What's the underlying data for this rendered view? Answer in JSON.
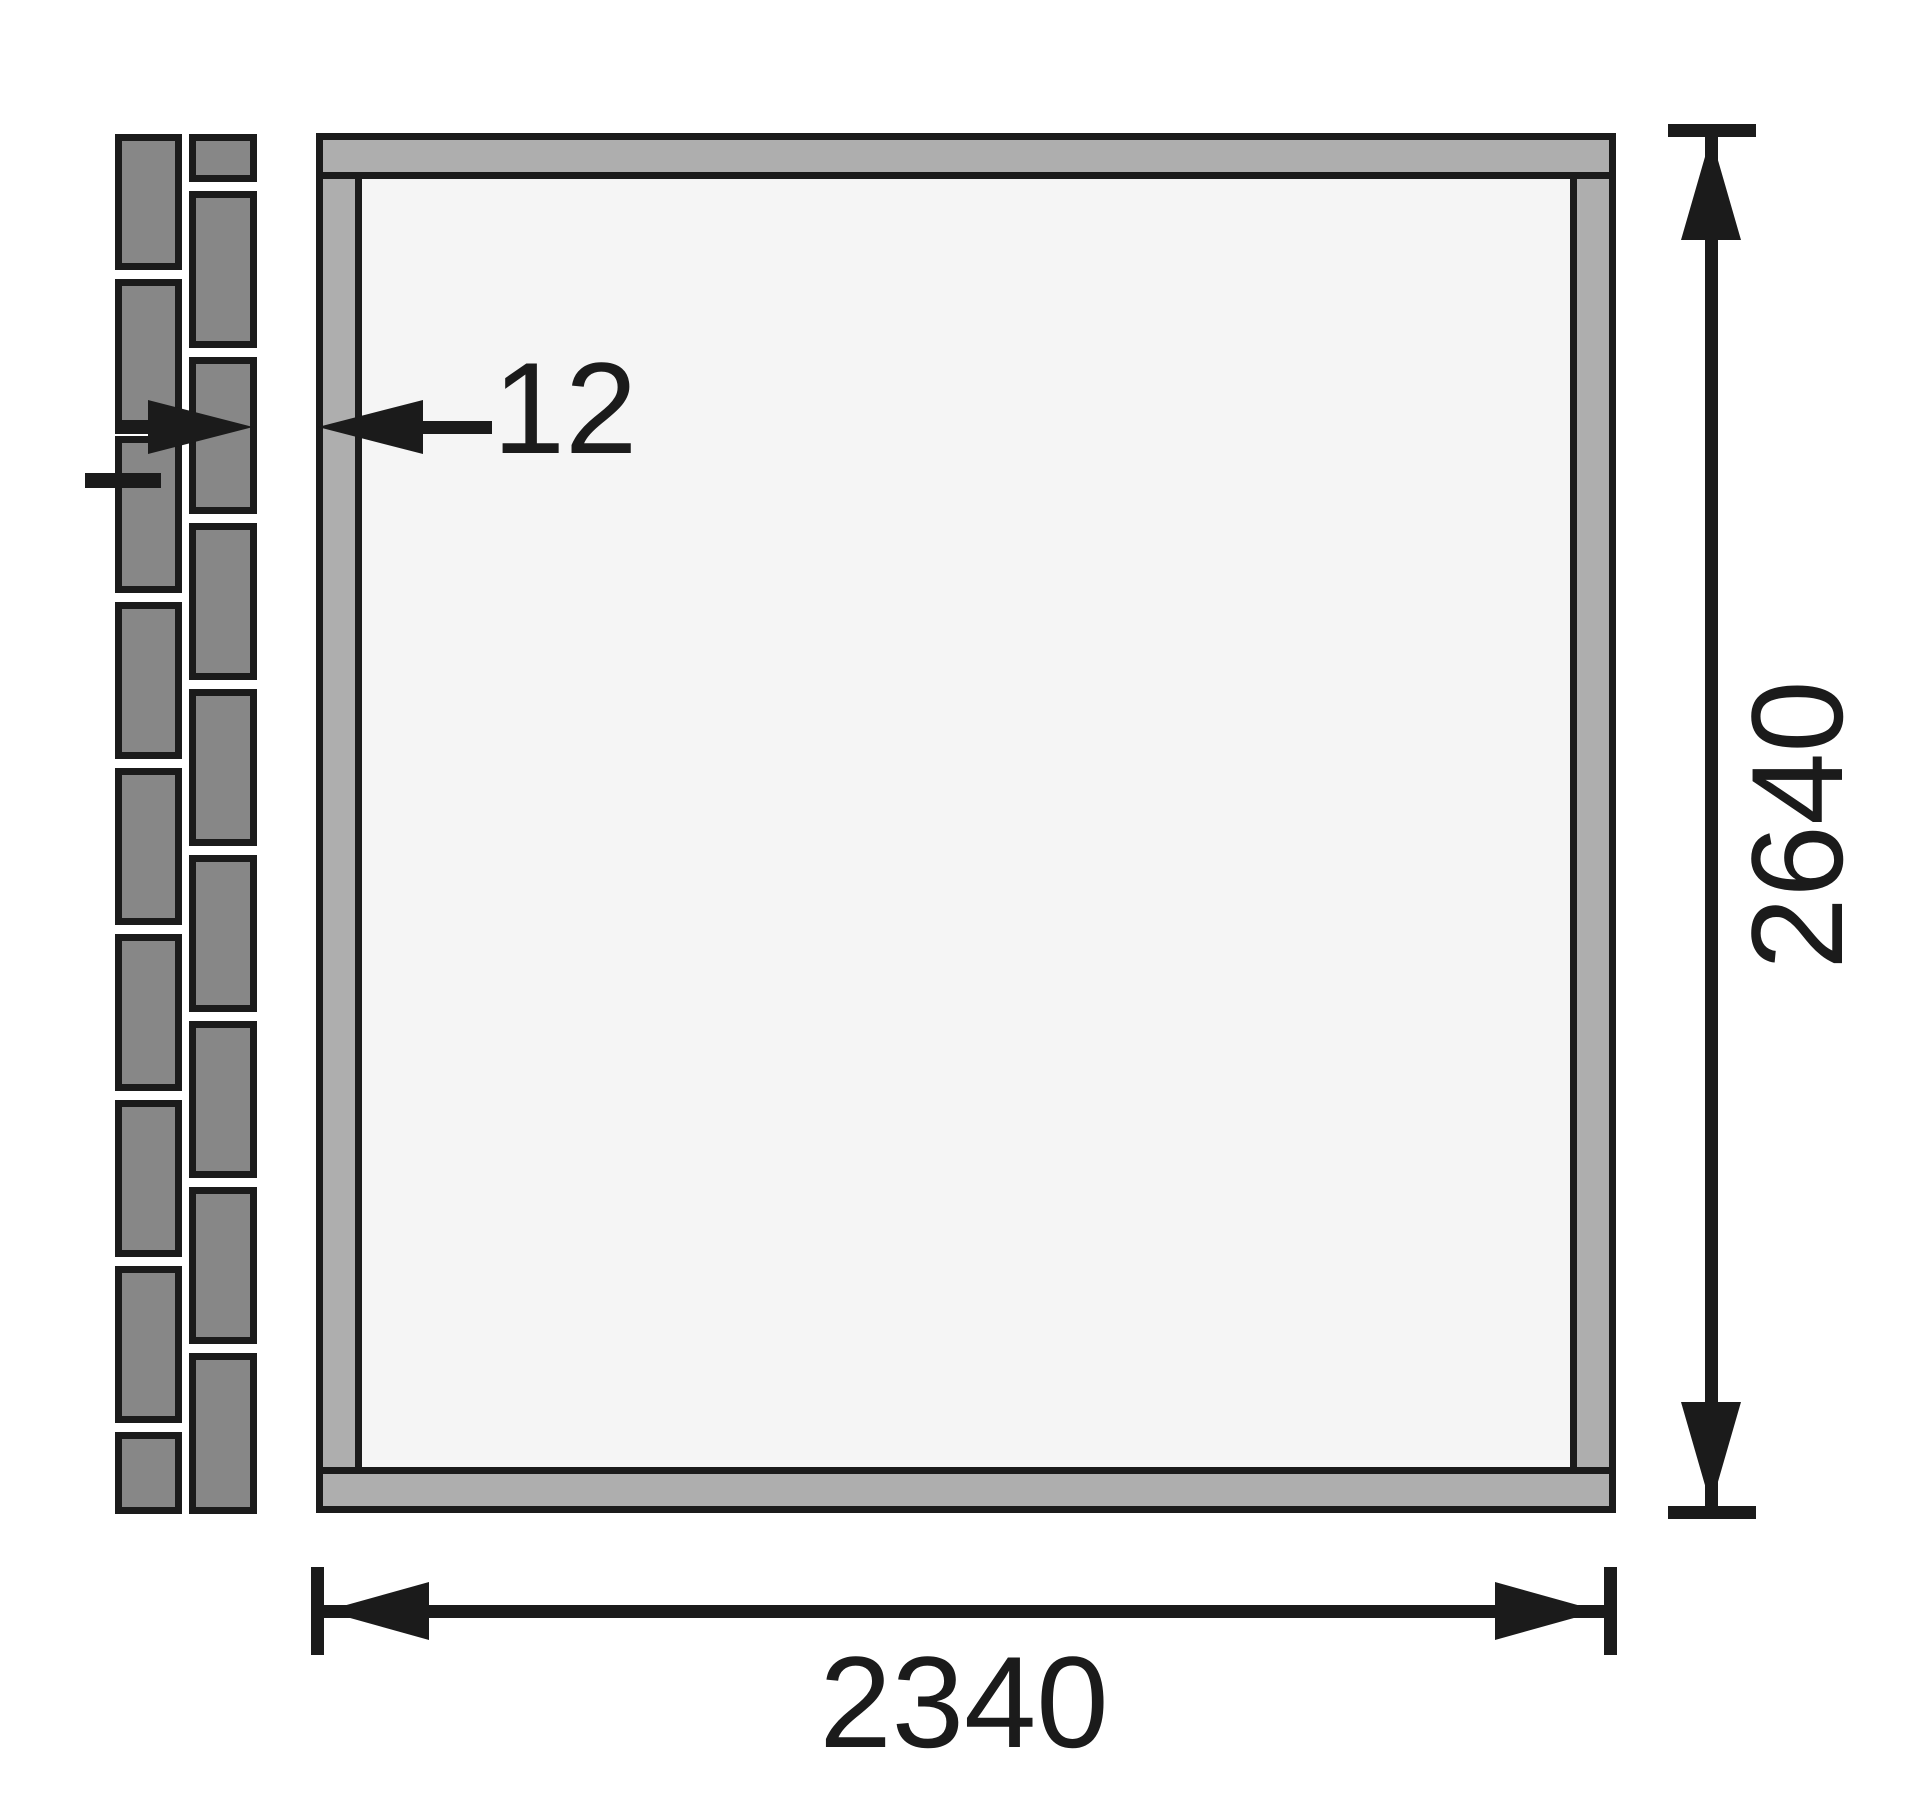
{
  "diagram": {
    "type": "technical-dimension-drawing",
    "description": "Cross-section plan: garden-house wall frame beside an existing masonry wall, with clearance and outer dimensions",
    "labels": {
      "wall_gap": "12",
      "outer_height": "2640",
      "outer_width": "2340"
    },
    "icons": {
      "arrow-up-icon": "solid triangle pointing up (dimension arrowhead)",
      "arrow-down-icon": "solid triangle pointing down (dimension arrowhead)",
      "arrow-left-icon": "solid triangle pointing left (dimension arrowhead)",
      "arrow-right-icon": "solid triangle pointing right (dimension arrowhead)"
    },
    "colors": {
      "ink": "#1b1b1b",
      "brick": "#878787",
      "frame": "#aeaeae",
      "floor": "#f5f5f5",
      "bg": "#ffffff"
    }
  }
}
